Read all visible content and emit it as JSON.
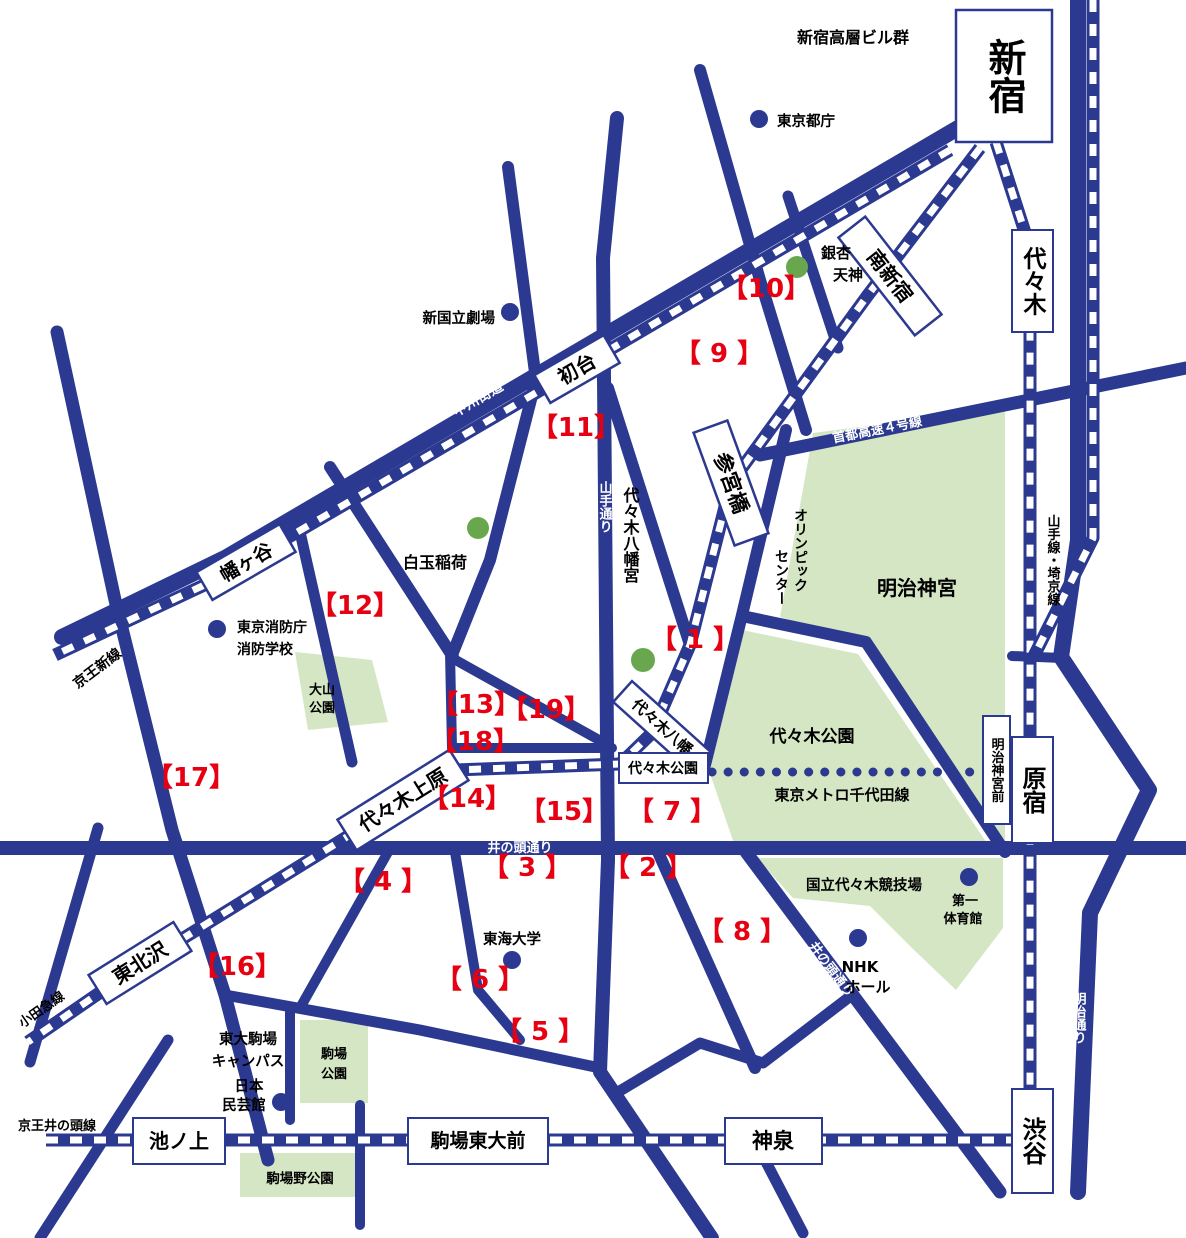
{
  "colors": {
    "road_navy": "#2b3990",
    "park_green": "#d4e6c3",
    "marker_red": "#e60012",
    "dot_green": "#69a74e",
    "station_bg": "#ffffff",
    "text_black": "#000000"
  },
  "stations": {
    "shinjuku": "新宿",
    "yoyogi": "代々木",
    "harajuku": "原宿",
    "meiji_jingumae": "明治神宮前",
    "shibuya": "渋谷",
    "minami_shinjuku": "南新宿",
    "sangubashi": "参宮橋",
    "yoyogi_hachiman": "代々木八幡",
    "yoyogi_koen": "代々木公園",
    "yoyogi_uehara": "代々木上原",
    "higashi_kitazawa": "東北沢",
    "hatsudai": "初台",
    "hatagaya": "幡ヶ谷",
    "ikenoue": "池ノ上",
    "komaba_todaimae": "駒場東大前",
    "shinsen": "神泉"
  },
  "railways": {
    "keio_new": "京王新線",
    "odakyu": "小田急線",
    "keio_inokashira": "京王井の頭線",
    "yamanote_saikyo": "山手線・埼京線",
    "chiyoda": "東京メトロ千代田線"
  },
  "roads": {
    "koshu_kaido": "甲州街道",
    "yamate_dori": "山手通り",
    "inokashira_dori": "井の頭通り",
    "inokashira_dori2": "井の頭通り",
    "meiji_dori": "明治通り",
    "shuto_expwy": "首都高速４号線"
  },
  "parks": {
    "meiji_jingu": "明治神宮",
    "yoyogi_park": "代々木公園",
    "stadium": "国立代々木競技場",
    "oyama_l1": "大山",
    "oyama_l2": "公園",
    "komaba_l1": "駒場",
    "komaba_l2": "公園",
    "komabano": "駒場野公園"
  },
  "pois": {
    "skyscrapers": "新宿高層ビル群",
    "tocho": "東京都庁",
    "theatre": "新国立劇場",
    "icho_l1": "銀杏",
    "icho_l2": "天神",
    "shiratama": "白玉稲荷",
    "fire_l1": "東京消防庁",
    "fire_l2": "消防学校",
    "hachimangu": "代々木八幡宮",
    "olympic_l1": "オリンピック",
    "olympic_l2": "センター",
    "daiichi_l1": "第一",
    "daiichi_l2": "体育館",
    "nhk_l1": "NHK",
    "nhk_l2": "ホール",
    "tokai": "東海大学",
    "todai_l1": "東大駒場",
    "todai_l2": "キャンパス",
    "mingei_l1": "日本",
    "mingei_l2": "民芸館"
  },
  "markers": {
    "m1": "【 1 】",
    "m2": "【 2 】",
    "m3": "【 3 】",
    "m4": "【 4 】",
    "m5": "【 5 】",
    "m6": "【 6 】",
    "m7": "【 7 】",
    "m8": "【 8 】",
    "m9": "【 9 】",
    "m10": "【10】",
    "m11": "【11】",
    "m12": "【12】",
    "m13": "【13】",
    "m14": "【14】",
    "m15": "【15】",
    "m16": "【16】",
    "m17": "【17】",
    "m18": "【18】",
    "m19": "【19】"
  }
}
